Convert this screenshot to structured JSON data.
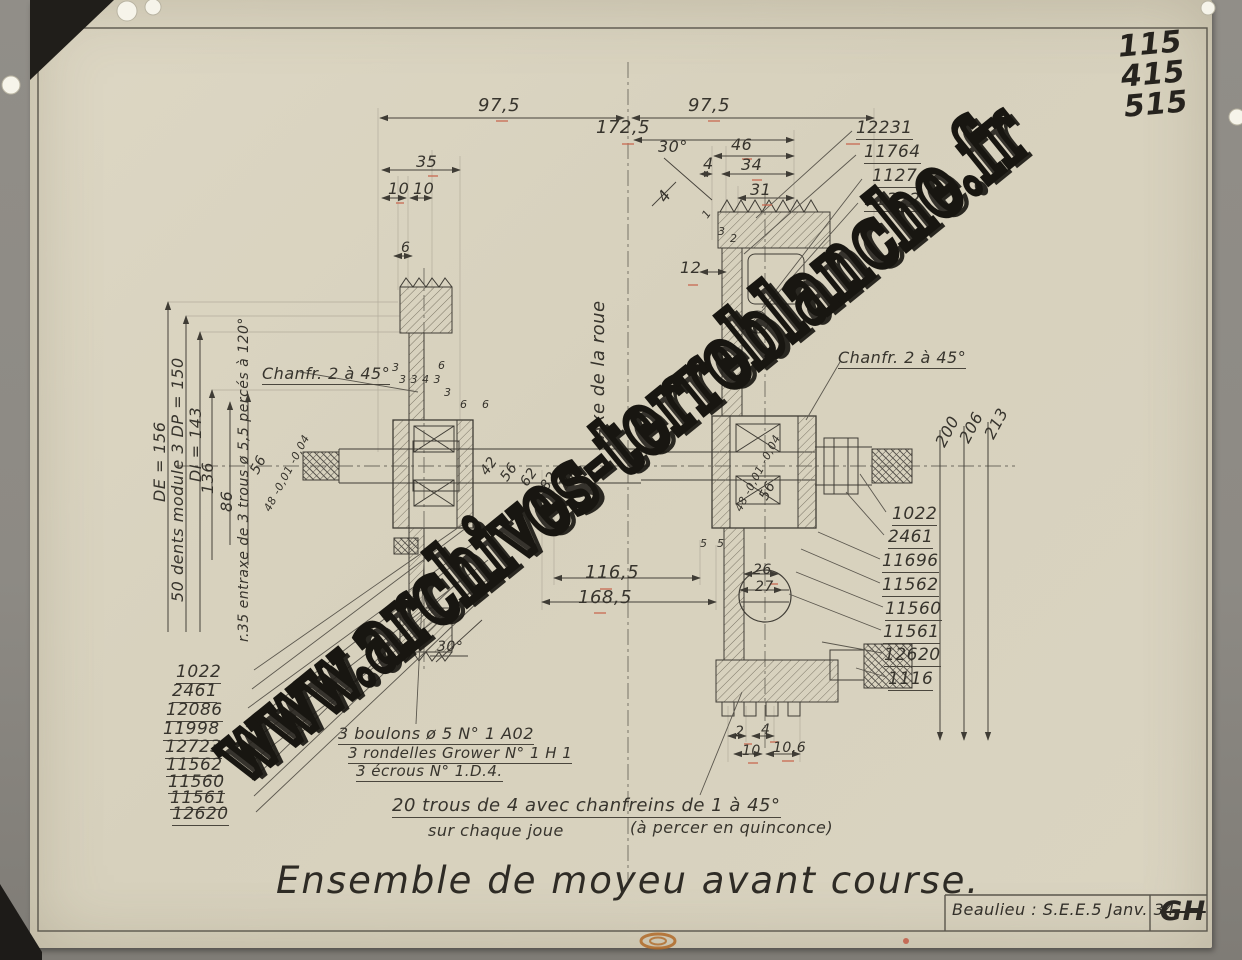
{
  "sheet": {
    "corner_numbers": [
      "115",
      "415",
      "515"
    ],
    "watermark": "www.archives-terreblanche.fr",
    "title": "Ensemble de moyeu avant course.",
    "credit": "Beaulieu : S.E.E.5 Janv. 34",
    "signature": "GH"
  },
  "annotations": {
    "axis": "Axe de la roue",
    "chamfer_left": "Chanfr. 2 à 45°",
    "chamfer_right": "Chanfr. 2 à 45°",
    "gear": "50 dents module 3   DP = 150",
    "de": "DE = 156",
    "di": "DI = 143",
    "r136": "136",
    "r86": "86",
    "entraxe": "r.35 entraxe de 3 trous ø 5,5 percés à 120°",
    "bolts_line1": "3 boulons ø 5   N° 1 A02",
    "bolts_line2": "3 rondelles Grower N° 1 H 1",
    "bolts_line3": "3 écrous   N°   1.D.4.",
    "holes_line1": "20 trous de 4 avec chanfreins de 1 à 45°",
    "holes_line2": "sur chaque joue",
    "holes_line3": "(à percer en quinconce)"
  },
  "dims": {
    "d975a": "97,5",
    "d975b": "97,5",
    "d1725": "172,5",
    "d35": "35",
    "d10a": "10",
    "d10b": "10",
    "d6": "6",
    "a30top": "30°",
    "d46": "46",
    "d4a": "4",
    "d34": "34",
    "d31": "31",
    "d4b": "4",
    "d12": "12",
    "d1": "1",
    "d3a": "3",
    "d2a": "2",
    "s3a": "3",
    "s3343": "3 3 4 3",
    "s6a": "6",
    "s3b": "3",
    "s6b": "6",
    "s6c": "6",
    "sh42": "42",
    "sh56": "56",
    "sh62": "62",
    "sh82": "82",
    "sh108": "108",
    "sh38": "38",
    "b56l": "56",
    "b48l": "48 -0,01 -0,04",
    "b48r": "48 -0,01 -0,04",
    "b56r": "56",
    "r200": "200",
    "r206": "206",
    "r213": "213",
    "d1165": "116,5",
    "d1685": "168,5",
    "d5a": "5",
    "d5b": "5",
    "d26": "26",
    "d27": "27",
    "a30bot": "30°",
    "d2b": "2",
    "d4c": "4",
    "d10c": "10",
    "d106": "10,6"
  },
  "parts": {
    "top_right": [
      "12231",
      "11764",
      "1127",
      "11322"
    ],
    "right": [
      "1022",
      "2461",
      "11696",
      "11562",
      "11560",
      "11561",
      "12620",
      "1116"
    ],
    "left": [
      "1022",
      "2461",
      "12086",
      "11998",
      "12723",
      "11562",
      "11560",
      "11561",
      "12620"
    ]
  }
}
